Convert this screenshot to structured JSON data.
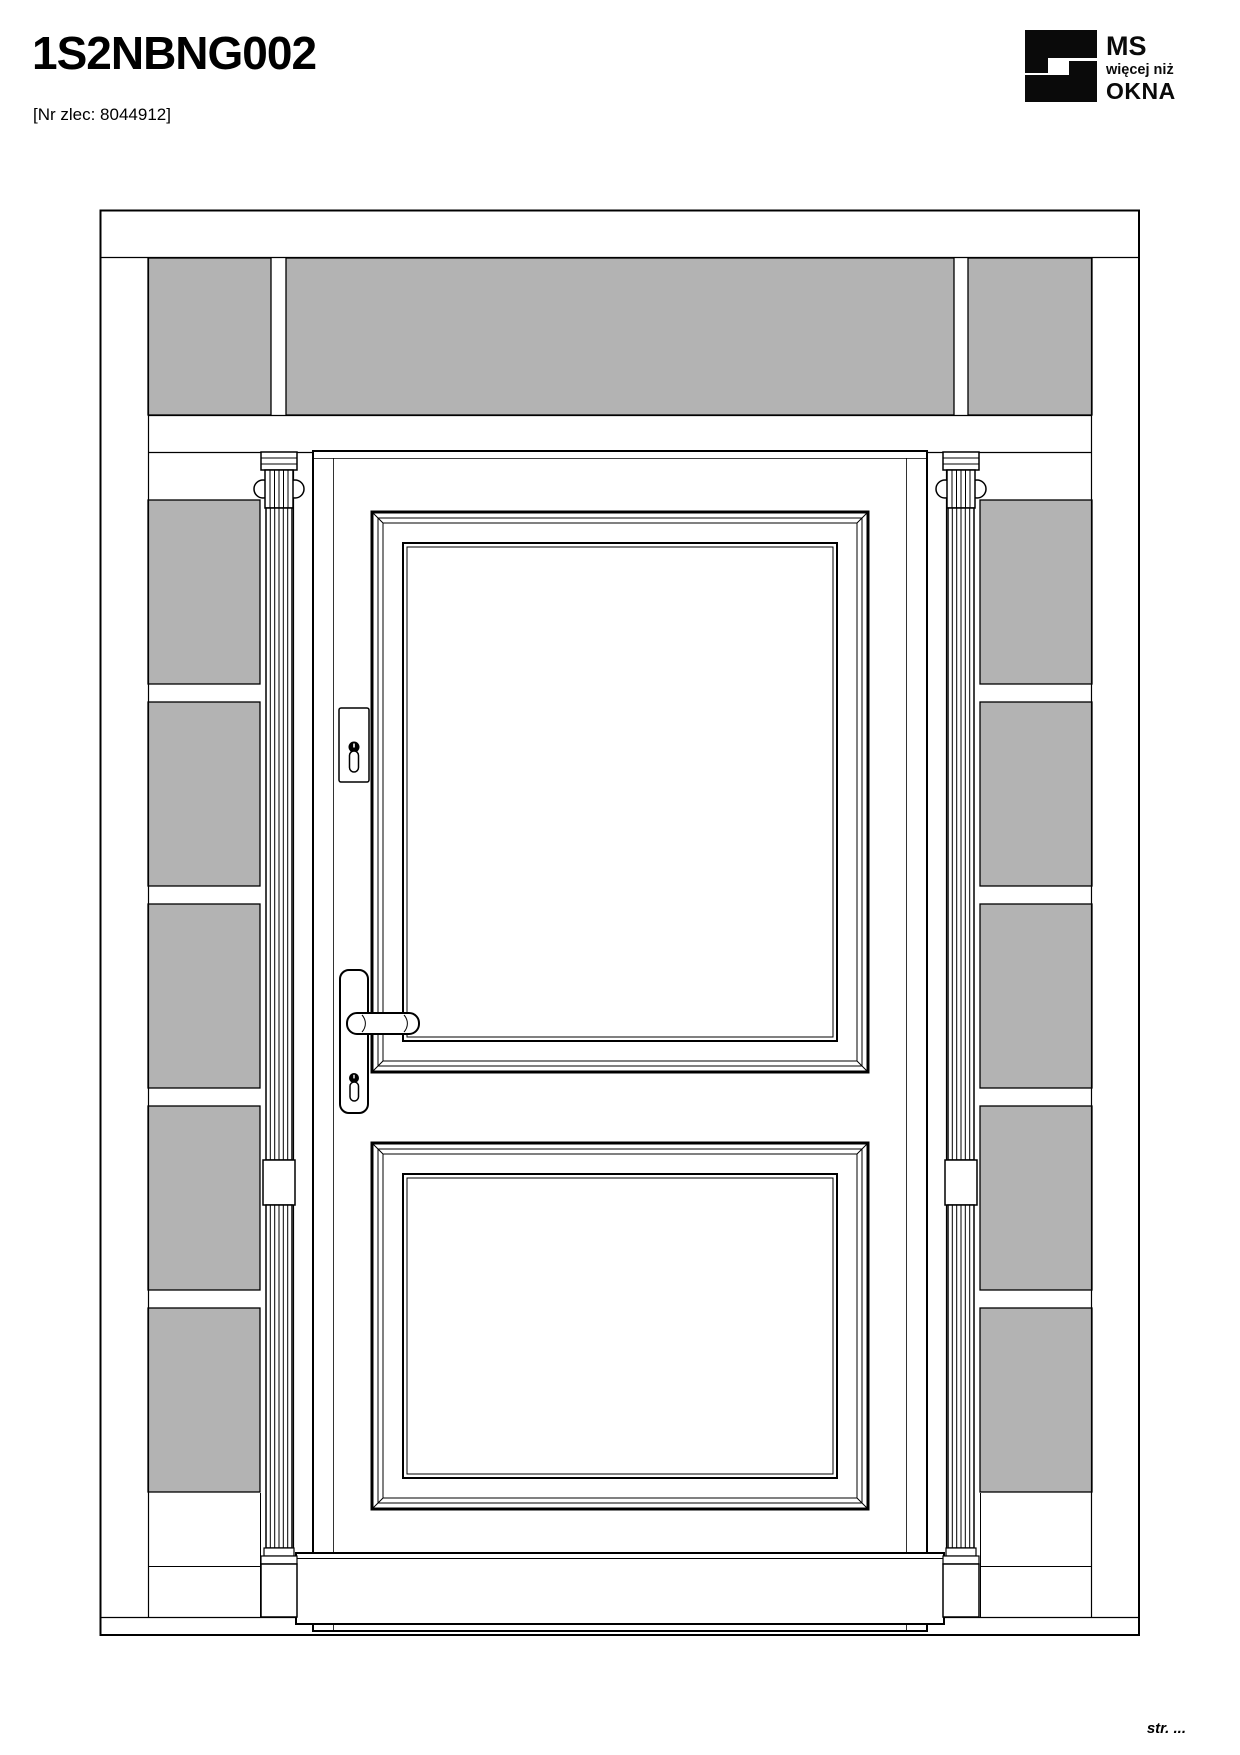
{
  "header": {
    "title": "1S2NBNG002",
    "order_ref": "[Nr zlec: 8044912]"
  },
  "logo": {
    "brand_top": "MS",
    "brand_middle": "więcej niż",
    "brand_bottom": "OKNA"
  },
  "footer": {
    "page_label": "str. ..."
  },
  "colors": {
    "glass": "#b3b3b3",
    "line": "#000000",
    "logo": "#0a0a0a",
    "background": "#ffffff"
  }
}
